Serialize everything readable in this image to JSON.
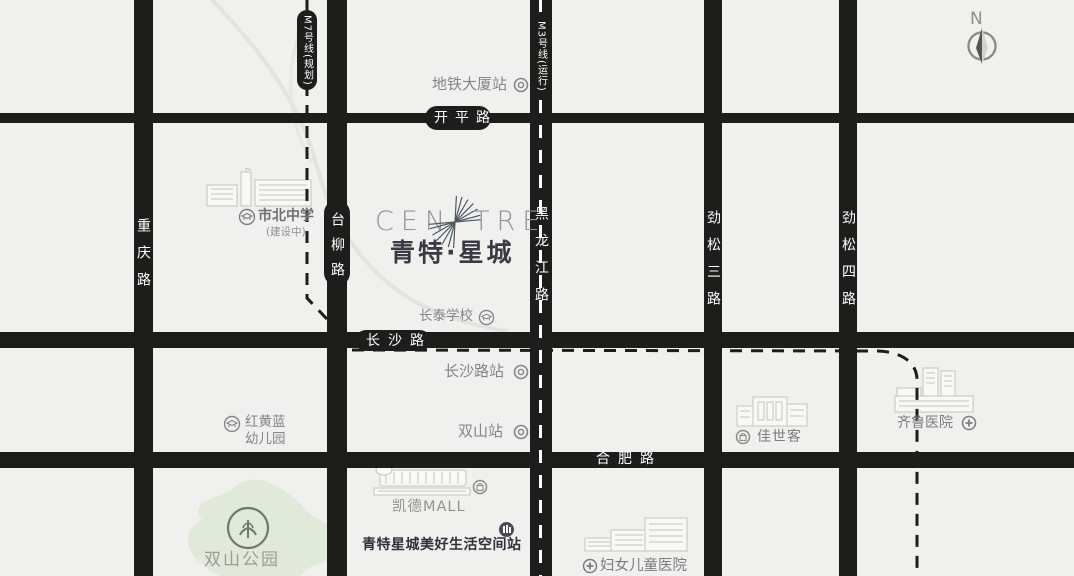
{
  "compass": {
    "label": "N"
  },
  "logo": {
    "en_left": "CEN",
    "en_right": "TRE",
    "cn": "青特·星城"
  },
  "metro": {
    "m7": {
      "label": "M7号线(规划)"
    },
    "m3": {
      "label": "M3号线(运行)"
    }
  },
  "roads": {
    "chongqing": {
      "name": "重庆路"
    },
    "tailiu": {
      "name": "台柳路"
    },
    "heilongjiang": {
      "name": "黑龙江路"
    },
    "jinsong3": {
      "name": "劲松三路"
    },
    "jinsong4": {
      "name": "劲松四路"
    },
    "kaiping": {
      "name": "开平路"
    },
    "changsha": {
      "name": "长沙路"
    },
    "hefei": {
      "name": "合肥路"
    }
  },
  "stations": {
    "ditiedasha": {
      "name": "地铁大厦站"
    },
    "changshalu": {
      "name": "长沙路站"
    },
    "shuangshan": {
      "name": "双山站"
    }
  },
  "pois": {
    "shibei": {
      "name": "市北中学",
      "note": "(建设中)"
    },
    "changtai": {
      "name": "长泰学校"
    },
    "honghuanglan": {
      "line1": "红黄蓝",
      "line2": "幼儿园"
    },
    "park": {
      "name": "双山公园"
    },
    "kaide": {
      "name": "凯德MALL"
    },
    "space_station": {
      "name": "青特星城美好生活空间站"
    },
    "funv": {
      "name": "妇女儿童医院"
    },
    "jiashike": {
      "name": "佳世客"
    },
    "qilu": {
      "name": "齐鲁医院"
    }
  },
  "colors": {
    "background": "#f0f0ee",
    "road": "#1d1d1b",
    "park_green": "#e0e9da",
    "gray_text": "#85858a",
    "dark_text": "#30303a",
    "logo_gray": "#8d949c"
  }
}
